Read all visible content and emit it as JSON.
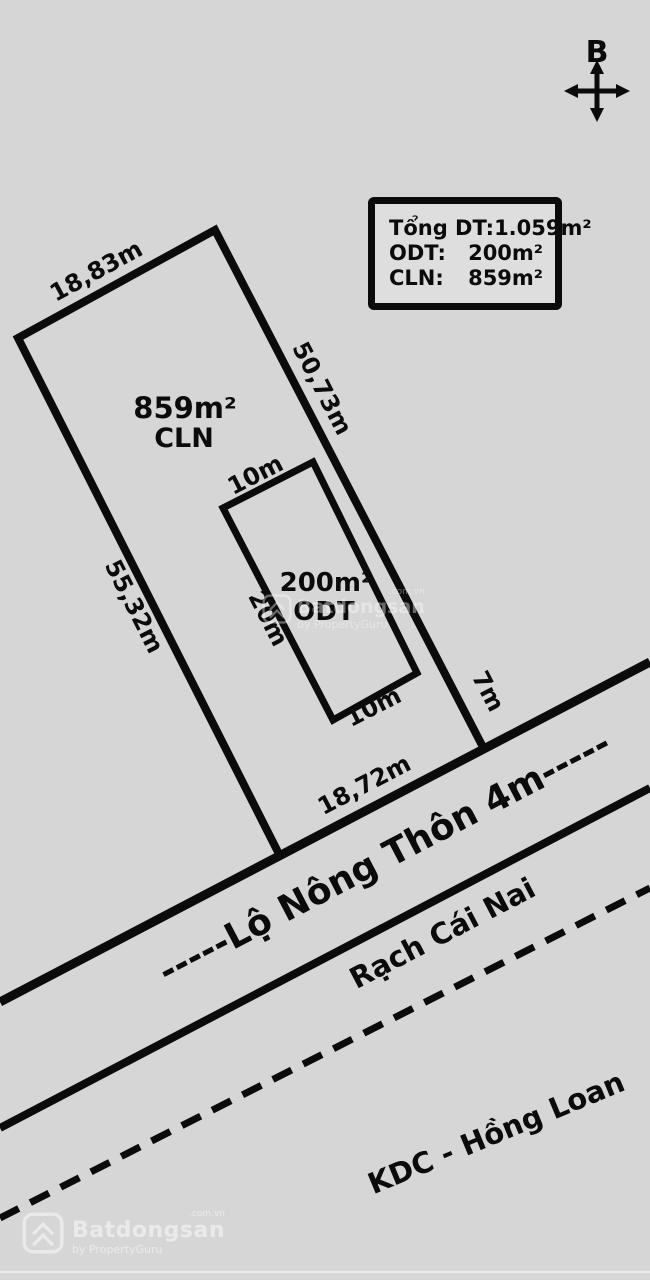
{
  "page": {
    "background": "#d6d6d6",
    "line_color": "#0b0b0b"
  },
  "compass": {
    "north_label": "B"
  },
  "info_box": {
    "rows": [
      {
        "label": "Tổng DT:",
        "value": "1.059m²"
      },
      {
        "label": "ODT:",
        "value": "200m²"
      },
      {
        "label": "CLN:",
        "value": "859m²"
      }
    ]
  },
  "main_plot": {
    "area": "859m²",
    "land_type": "CLN",
    "dim_top": "18,83m",
    "dim_right_upper": "50,73m",
    "dim_right_lower": "7m",
    "dim_left": "55,32m",
    "dim_bottom": "18,72m"
  },
  "inner_plot": {
    "area": "200m²",
    "land_type": "ODT",
    "dim_top": "10m",
    "dim_left": "20m",
    "dim_bottom": "10m"
  },
  "road": {
    "label": "-----Lộ Nông Thôn 4m-----"
  },
  "canal": {
    "label": "Rạch Cái Nai"
  },
  "neighborhood": {
    "label": "KDC - Hồng Loan"
  },
  "watermark": {
    "brand": "Batdongsan",
    "domain": ".com.vn",
    "byline": "by PropertyGuru"
  }
}
